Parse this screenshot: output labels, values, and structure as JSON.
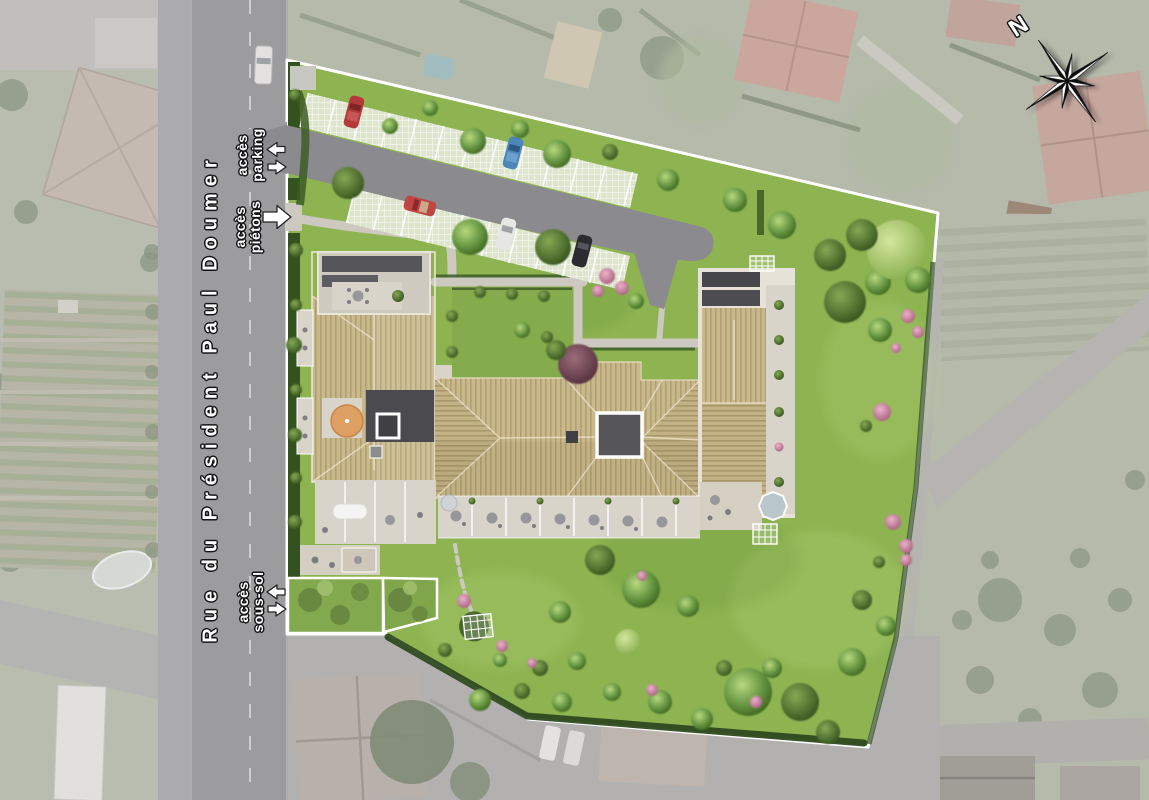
{
  "site_plan": {
    "street": {
      "name": "Rue du Président Paul Doumer"
    },
    "access_labels": {
      "parking": {
        "line1": "accès",
        "line2": "parking"
      },
      "pedestrians": {
        "line1": "accès",
        "line2": "piétons"
      },
      "basement": {
        "line1": "accès",
        "line2": "sous-sol"
      }
    },
    "compass": {
      "north_label": "N"
    },
    "colors": {
      "lawn": "#8db451",
      "street_asphalt": "#9c9c9e",
      "parking_asphalt": "#8b8a8e",
      "flat_roof": "#4b4b4f",
      "wood_roof": "#c9b88a",
      "terrace": "#d9d4c9",
      "boundary_line": "#ffffff",
      "hedge": "#33521f"
    }
  }
}
